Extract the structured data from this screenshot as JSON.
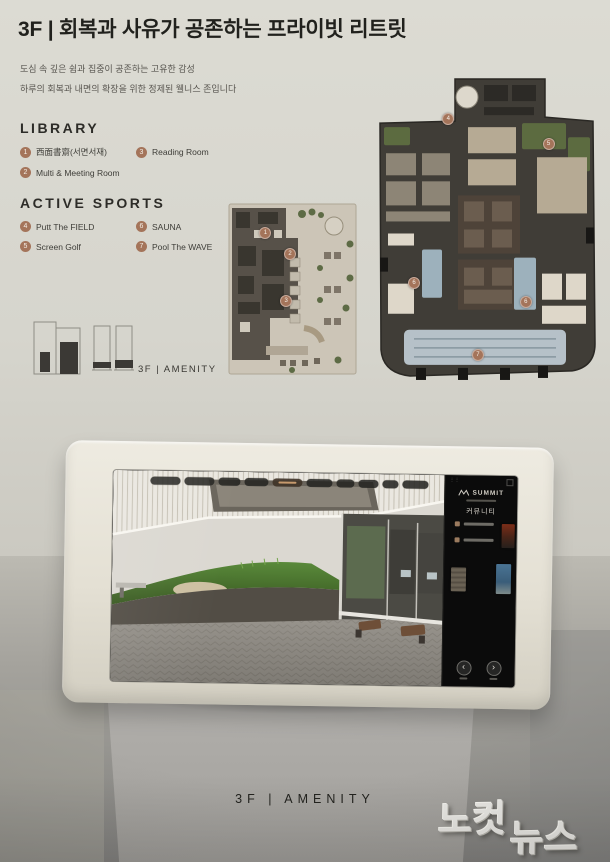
{
  "board": {
    "title": "3F | 회복과 사유가 공존하는 프라이빗 리트릿",
    "subtitle_lines": [
      "도심 속 깊은 쉼과 집중이 공존하는 고유한 감성",
      "하루의 회복과 내면의 확장을 위한 정제된 웰니스 존입니다"
    ],
    "legend_sections": [
      {
        "heading": "LIBRARY",
        "items": [
          {
            "num": "1",
            "label": "西面書齋(서면서재)"
          },
          {
            "num": "3",
            "label": "Reading Room"
          },
          {
            "num": "2",
            "label": "Multi & Meeting Room"
          }
        ]
      },
      {
        "heading": "ACTIVE SPORTS",
        "items": [
          {
            "num": "4",
            "label": "Putt The FIELD"
          },
          {
            "num": "6",
            "label": "SAUNA"
          },
          {
            "num": "5",
            "label": "Screen Golf"
          },
          {
            "num": "7",
            "label": "Pool The WAVE"
          }
        ]
      }
    ],
    "massing_label": "3F | AMENITY",
    "marker_color": "#a4745a",
    "floorplans": {
      "mid_markers": [
        {
          "num": "1",
          "x": 28,
          "y": 18
        },
        {
          "num": "2",
          "x": 47,
          "y": 30
        },
        {
          "num": "3",
          "x": 44,
          "y": 56
        }
      ],
      "lg_markers": [
        {
          "num": "4",
          "x": 33,
          "y": 13
        },
        {
          "num": "5",
          "x": 77,
          "y": 21
        },
        {
          "num": "6",
          "x": 18,
          "y": 65
        },
        {
          "num": "6",
          "x": 67,
          "y": 71
        },
        {
          "num": "7",
          "x": 46,
          "y": 88
        }
      ]
    }
  },
  "kiosk": {
    "screen": {
      "nav_pill_count": 10,
      "active_pill_index": 4,
      "panel": {
        "brand": "SUMMIT",
        "menu_label": "커뮤니티",
        "prev_glyph": "‹",
        "next_glyph": "›"
      }
    }
  },
  "footer_label": "3F | AMENITY",
  "watermark": {
    "part1": "노컷",
    "part2": "뉴스"
  }
}
